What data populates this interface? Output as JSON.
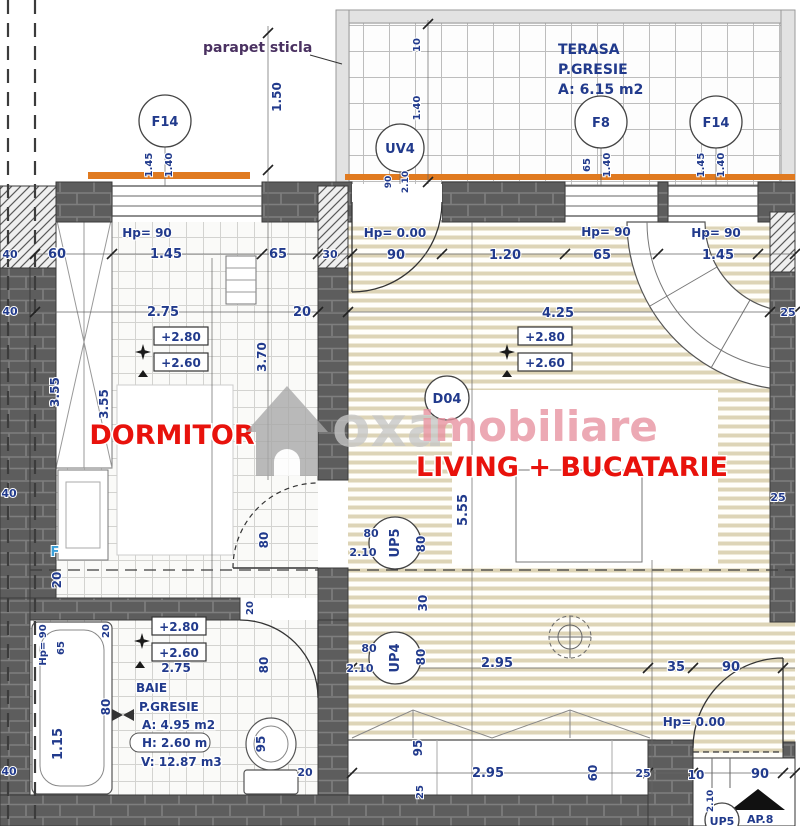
{
  "colors": {
    "dim_text": "#213a8c",
    "room_red": "#e8120c",
    "f_blue": "#3b9fd8",
    "orange": "#e07a20",
    "wall": "#5d5d5d",
    "watermark_gray": "#c6c6c6",
    "watermark_pink": "#e7919f",
    "parapet_label": "#4a3161"
  },
  "rooms": {
    "terasa": {
      "name": "TERASA",
      "finish": "P.GRESIE",
      "area": "A: 6.15 m2"
    },
    "dormitor": {
      "name": "DORMITOR"
    },
    "living": {
      "name": "LIVING + BUCATARIE"
    },
    "baie": {
      "name": "BAIE",
      "finish": "P.GRESIE",
      "area": "A: 4.95 m2",
      "height": "H: 2.60 m",
      "volume": "V: 12.87 m3"
    }
  },
  "annotations": {
    "parapet": "parapet sticla",
    "apartment": "AP.8",
    "floor_marker": "F"
  },
  "codes": {
    "window_left": "F14",
    "terrace_door": "UV4",
    "window_f8": "F8",
    "window_right": "F14",
    "living_door": "D04",
    "door_up5": "UP5",
    "door_up4": "UP4",
    "entry_up5": "UP5"
  },
  "watermark": {
    "part1": "oxa",
    "part2": "imobiliare"
  },
  "dims": [
    {
      "t": "1.50",
      "x": 281,
      "y": 97,
      "r": 1
    },
    {
      "t": "10",
      "x": 420,
      "y": 45,
      "r": 1,
      "s": 10
    },
    {
      "t": "1.40",
      "x": 420,
      "y": 108,
      "r": 1,
      "s": 10
    },
    {
      "t": "1.45",
      "x": 152,
      "y": 165,
      "r": 1,
      "s": 10
    },
    {
      "t": "1.40",
      "x": 172,
      "y": 165,
      "r": 1,
      "s": 10
    },
    {
      "t": "90",
      "x": 391,
      "y": 182,
      "r": 1,
      "s": 9
    },
    {
      "t": "2.10",
      "x": 408,
      "y": 182,
      "r": 1,
      "s": 9
    },
    {
      "t": "65",
      "x": 590,
      "y": 165,
      "r": 1,
      "s": 10
    },
    {
      "t": "1.40",
      "x": 610,
      "y": 165,
      "r": 1,
      "s": 10
    },
    {
      "t": "1.45",
      "x": 704,
      "y": 165,
      "r": 1,
      "s": 10
    },
    {
      "t": "1.40",
      "x": 724,
      "y": 165,
      "r": 1,
      "s": 10
    },
    {
      "t": "Hp= 90",
      "x": 147,
      "y": 237
    },
    {
      "t": "1.45",
      "x": 166,
      "y": 258,
      "s": 13
    },
    {
      "t": "60",
      "x": 57,
      "y": 258,
      "s": 13
    },
    {
      "t": "65",
      "x": 278,
      "y": 258,
      "s": 13
    },
    {
      "t": "30",
      "x": 330,
      "y": 258,
      "s": 11
    },
    {
      "t": "40",
      "x": 10,
      "y": 258,
      "s": 11
    },
    {
      "t": "Hp= 0.00",
      "x": 395,
      "y": 237
    },
    {
      "t": "90",
      "x": 396,
      "y": 259,
      "s": 13
    },
    {
      "t": "1.20",
      "x": 505,
      "y": 259,
      "s": 13
    },
    {
      "t": "65",
      "x": 602,
      "y": 259,
      "s": 13
    },
    {
      "t": "Hp= 90",
      "x": 606,
      "y": 236
    },
    {
      "t": "Hp= 90",
      "x": 716,
      "y": 237
    },
    {
      "t": "1.45",
      "x": 718,
      "y": 259,
      "s": 13
    },
    {
      "t": "40",
      "x": 10,
      "y": 315,
      "s": 11
    },
    {
      "t": "2.75",
      "x": 163,
      "y": 316,
      "s": 13
    },
    {
      "t": "20",
      "x": 302,
      "y": 316,
      "s": 13
    },
    {
      "t": "4.25",
      "x": 558,
      "y": 317,
      "s": 13
    },
    {
      "t": "25",
      "x": 788,
      "y": 316,
      "s": 11
    },
    {
      "t": "+2.80",
      "x": 181,
      "y": 341,
      "box": 1
    },
    {
      "t": "+2.60",
      "x": 181,
      "y": 367,
      "box": 1
    },
    {
      "t": "+2.80",
      "x": 545,
      "y": 341,
      "box": 1
    },
    {
      "t": "+2.60",
      "x": 545,
      "y": 367,
      "box": 1
    },
    {
      "t": "3.70",
      "x": 266,
      "y": 357,
      "r": 1
    },
    {
      "t": "3.55",
      "x": 59,
      "y": 392,
      "r": 1
    },
    {
      "t": "3.55",
      "x": 108,
      "y": 404,
      "r": 1
    },
    {
      "t": "5.55",
      "x": 467,
      "y": 510,
      "r": 1,
      "s": 13
    },
    {
      "t": "25",
      "x": 778,
      "y": 501,
      "s": 11
    },
    {
      "t": "F",
      "x": 55,
      "y": 556,
      "c": "blue",
      "s": 13
    },
    {
      "t": "20",
      "x": 61,
      "y": 580,
      "r": 1
    },
    {
      "t": "80",
      "x": 268,
      "y": 540,
      "r": 1
    },
    {
      "t": "20",
      "x": 253,
      "y": 608,
      "r": 1,
      "s": 10
    },
    {
      "t": "80",
      "x": 371,
      "y": 537,
      "s": 11
    },
    {
      "t": "2.10",
      "x": 363,
      "y": 556,
      "s": 11
    },
    {
      "t": "80",
      "x": 425,
      "y": 544,
      "r": 1
    },
    {
      "t": "30",
      "x": 427,
      "y": 603,
      "r": 1
    },
    {
      "t": "80",
      "x": 369,
      "y": 652,
      "s": 11
    },
    {
      "t": "2.10",
      "x": 360,
      "y": 672,
      "s": 11
    },
    {
      "t": "80",
      "x": 425,
      "y": 657,
      "r": 1
    },
    {
      "t": "Hp= 90",
      "x": 46,
      "y": 645,
      "r": 1,
      "s": 10
    },
    {
      "t": "65",
      "x": 64,
      "y": 648,
      "r": 1,
      "s": 10
    },
    {
      "t": "20",
      "x": 109,
      "y": 631,
      "r": 1,
      "s": 10
    },
    {
      "t": "80",
      "x": 110,
      "y": 707,
      "r": 1
    },
    {
      "t": "1.15",
      "x": 62,
      "y": 744,
      "r": 1,
      "s": 13
    },
    {
      "t": "+2.80",
      "x": 179,
      "y": 631,
      "box": 1
    },
    {
      "t": "+2.60",
      "x": 179,
      "y": 657,
      "box": 1
    },
    {
      "t": "2.75",
      "x": 176,
      "y": 672,
      "s": 12
    },
    {
      "t": "80",
      "x": 268,
      "y": 665,
      "r": 1
    },
    {
      "t": "95",
      "x": 265,
      "y": 744,
      "r": 1
    },
    {
      "t": "20",
      "x": 305,
      "y": 776,
      "s": 11
    },
    {
      "t": "2.95",
      "x": 497,
      "y": 667,
      "s": 13
    },
    {
      "t": "35",
      "x": 676,
      "y": 671,
      "s": 13
    },
    {
      "t": "90",
      "x": 731,
      "y": 671,
      "s": 13
    },
    {
      "t": "Hp= 0.00",
      "x": 694,
      "y": 726
    },
    {
      "t": "95",
      "x": 422,
      "y": 748,
      "r": 1
    },
    {
      "t": "25",
      "x": 423,
      "y": 792,
      "r": 1,
      "s": 10
    },
    {
      "t": "2.95",
      "x": 488,
      "y": 777,
      "s": 13
    },
    {
      "t": "60",
      "x": 597,
      "y": 773,
      "r": 1
    },
    {
      "t": "25",
      "x": 643,
      "y": 777,
      "s": 11
    },
    {
      "t": "10",
      "x": 696,
      "y": 779,
      "s": 12
    },
    {
      "t": "90",
      "x": 760,
      "y": 778,
      "s": 13
    },
    {
      "t": "2.10",
      "x": 713,
      "y": 801,
      "r": 1,
      "s": 9
    },
    {
      "t": "40",
      "x": 9,
      "y": 497,
      "s": 11
    },
    {
      "t": "40",
      "x": 9,
      "y": 775,
      "s": 11
    }
  ]
}
